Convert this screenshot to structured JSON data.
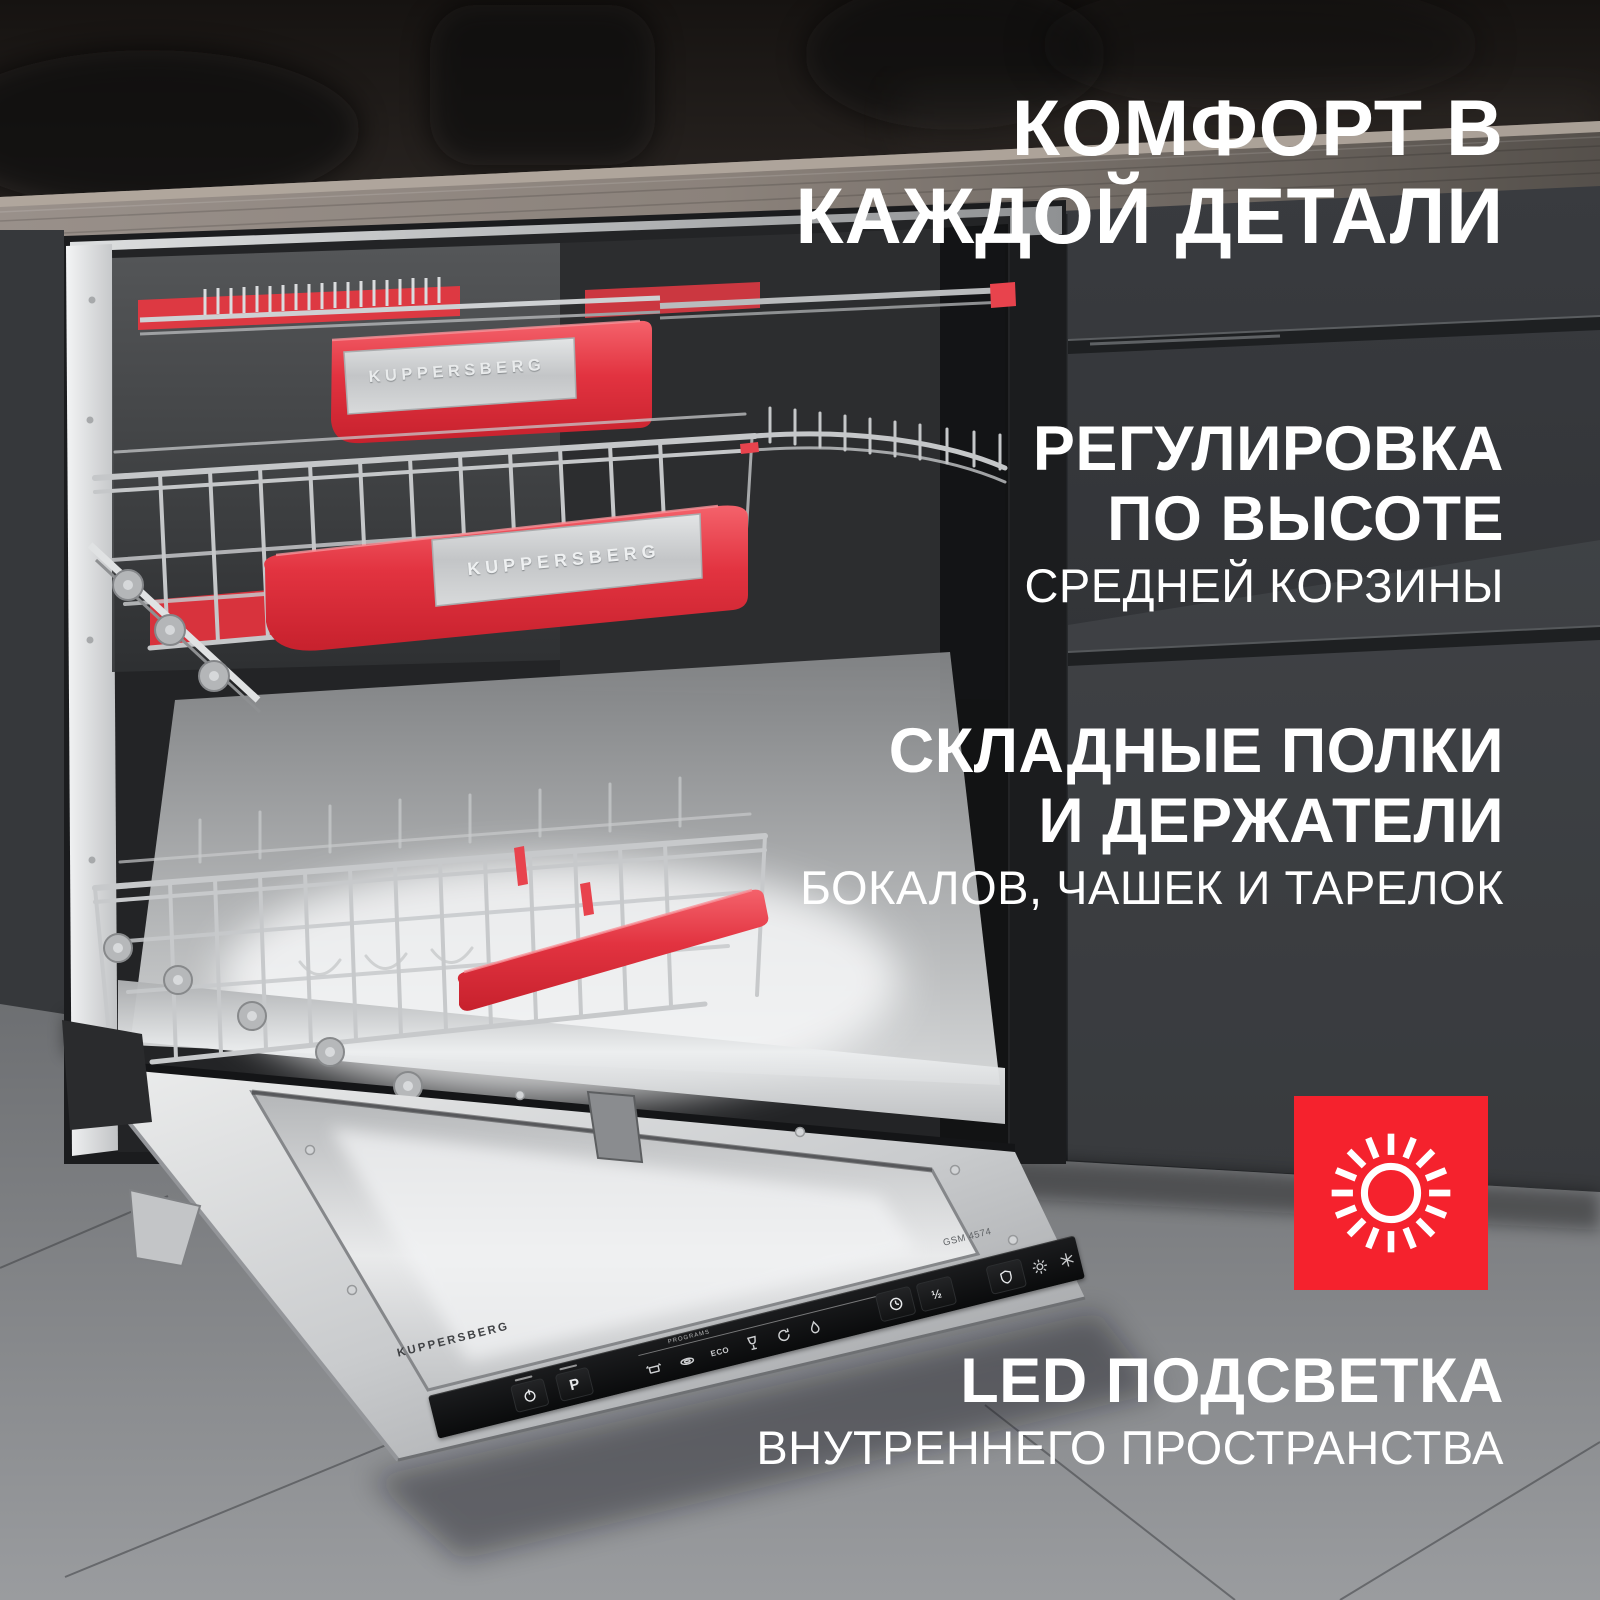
{
  "headline": {
    "line1": "КОМФОРТ В",
    "line2": "КАЖДОЙ ДЕТАЛИ"
  },
  "features": [
    {
      "bold1": "РЕГУЛИРОВКА",
      "bold2": "ПО ВЫСОТЕ",
      "light1": "СРЕДНЕЙ КОРЗИНЫ"
    },
    {
      "bold1": "СКЛАДНЫЕ ПОЛКИ",
      "bold2": "И ДЕРЖАТЕЛИ",
      "light1": "БОКАЛОВ, ЧАШЕК И ТАРЕЛОК"
    },
    {
      "bold1": "LED ПОДСВЕТКА",
      "light1": "ВНУТРЕННЕГО ПРОСТРАНСТВА"
    }
  ],
  "led_badge": {
    "icon": "sun-icon",
    "bg_color": "#F5222D",
    "fg_color": "#FFFFFF"
  },
  "appliance": {
    "top_tray_plate": "KUPPERSBERG",
    "middle_basket_plate": "KUPPERSBERG",
    "door_logo": "KUPPERSBERG",
    "model_label": "GSM 4574",
    "control_panel": {
      "programs_label": "PROGRAMS",
      "program_button_label": "P",
      "eco_program_label": "ECO",
      "half_load_label": "½"
    }
  },
  "colors": {
    "accent_red": "#F5222D",
    "handle_red": "#E8434D",
    "text_white": "#FFFFFF"
  }
}
